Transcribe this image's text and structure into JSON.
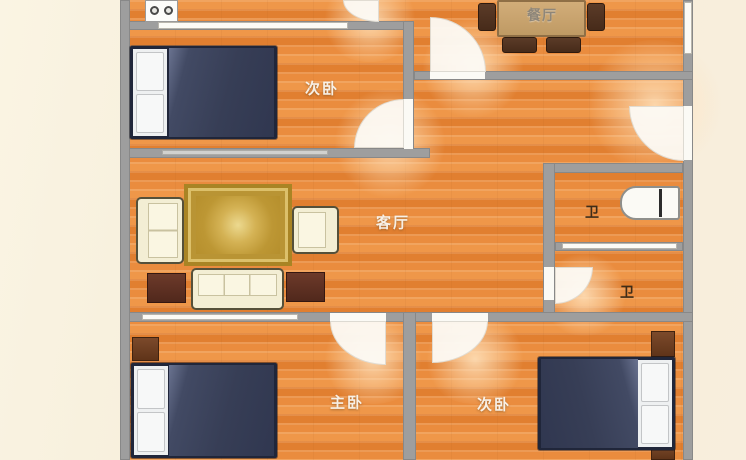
{
  "floor_plan": {
    "rooms": [
      {
        "name": "bedroom-secondary-top",
        "label": "次卧"
      },
      {
        "name": "dining-room",
        "label": "餐厅"
      },
      {
        "name": "living-room",
        "label": "客厅"
      },
      {
        "name": "bathroom-upper",
        "label": "卫"
      },
      {
        "name": "bathroom-lower",
        "label": "卫"
      },
      {
        "name": "bedroom-master",
        "label": "主卧"
      },
      {
        "name": "bedroom-secondary-bottom",
        "label": "次卧"
      }
    ],
    "colors": {
      "background": "#f6edd8",
      "floor_wood": "#e8873c",
      "wall": "#9e9e9e",
      "bed_duvet": "#3b4259",
      "rug_gold": "#c9a53f",
      "sofa_cream": "#f3eed4",
      "dining_table_wood": "#c7a26d",
      "dark_furniture_wood": "#5d3126"
    }
  }
}
